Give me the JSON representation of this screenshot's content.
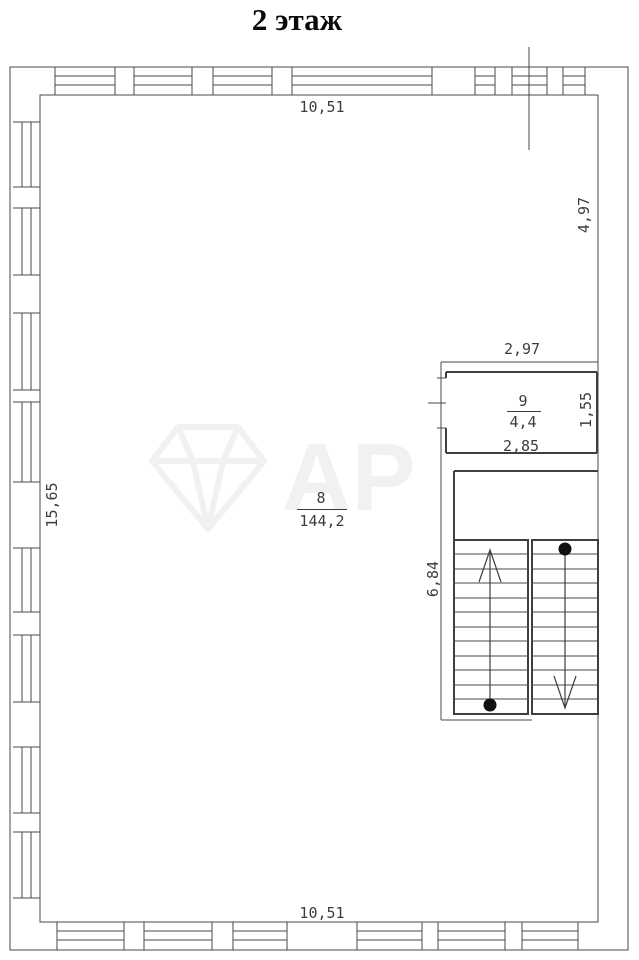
{
  "title": "2 этаж",
  "watermark": {
    "icon": "gem-icon",
    "letters": "АР"
  },
  "rooms": {
    "room8": {
      "number": "8",
      "area": "144,2"
    },
    "room9": {
      "number": "9",
      "area": "4,4"
    }
  },
  "dimensions": {
    "building_top": "10,51",
    "building_bottom": "10,51",
    "building_left": "15,65",
    "building_right": "4,97",
    "room9_width_top": "2,97",
    "room9_width_bottom": "2,85",
    "room9_height": "1,55",
    "staircase_height": "6,84"
  }
}
